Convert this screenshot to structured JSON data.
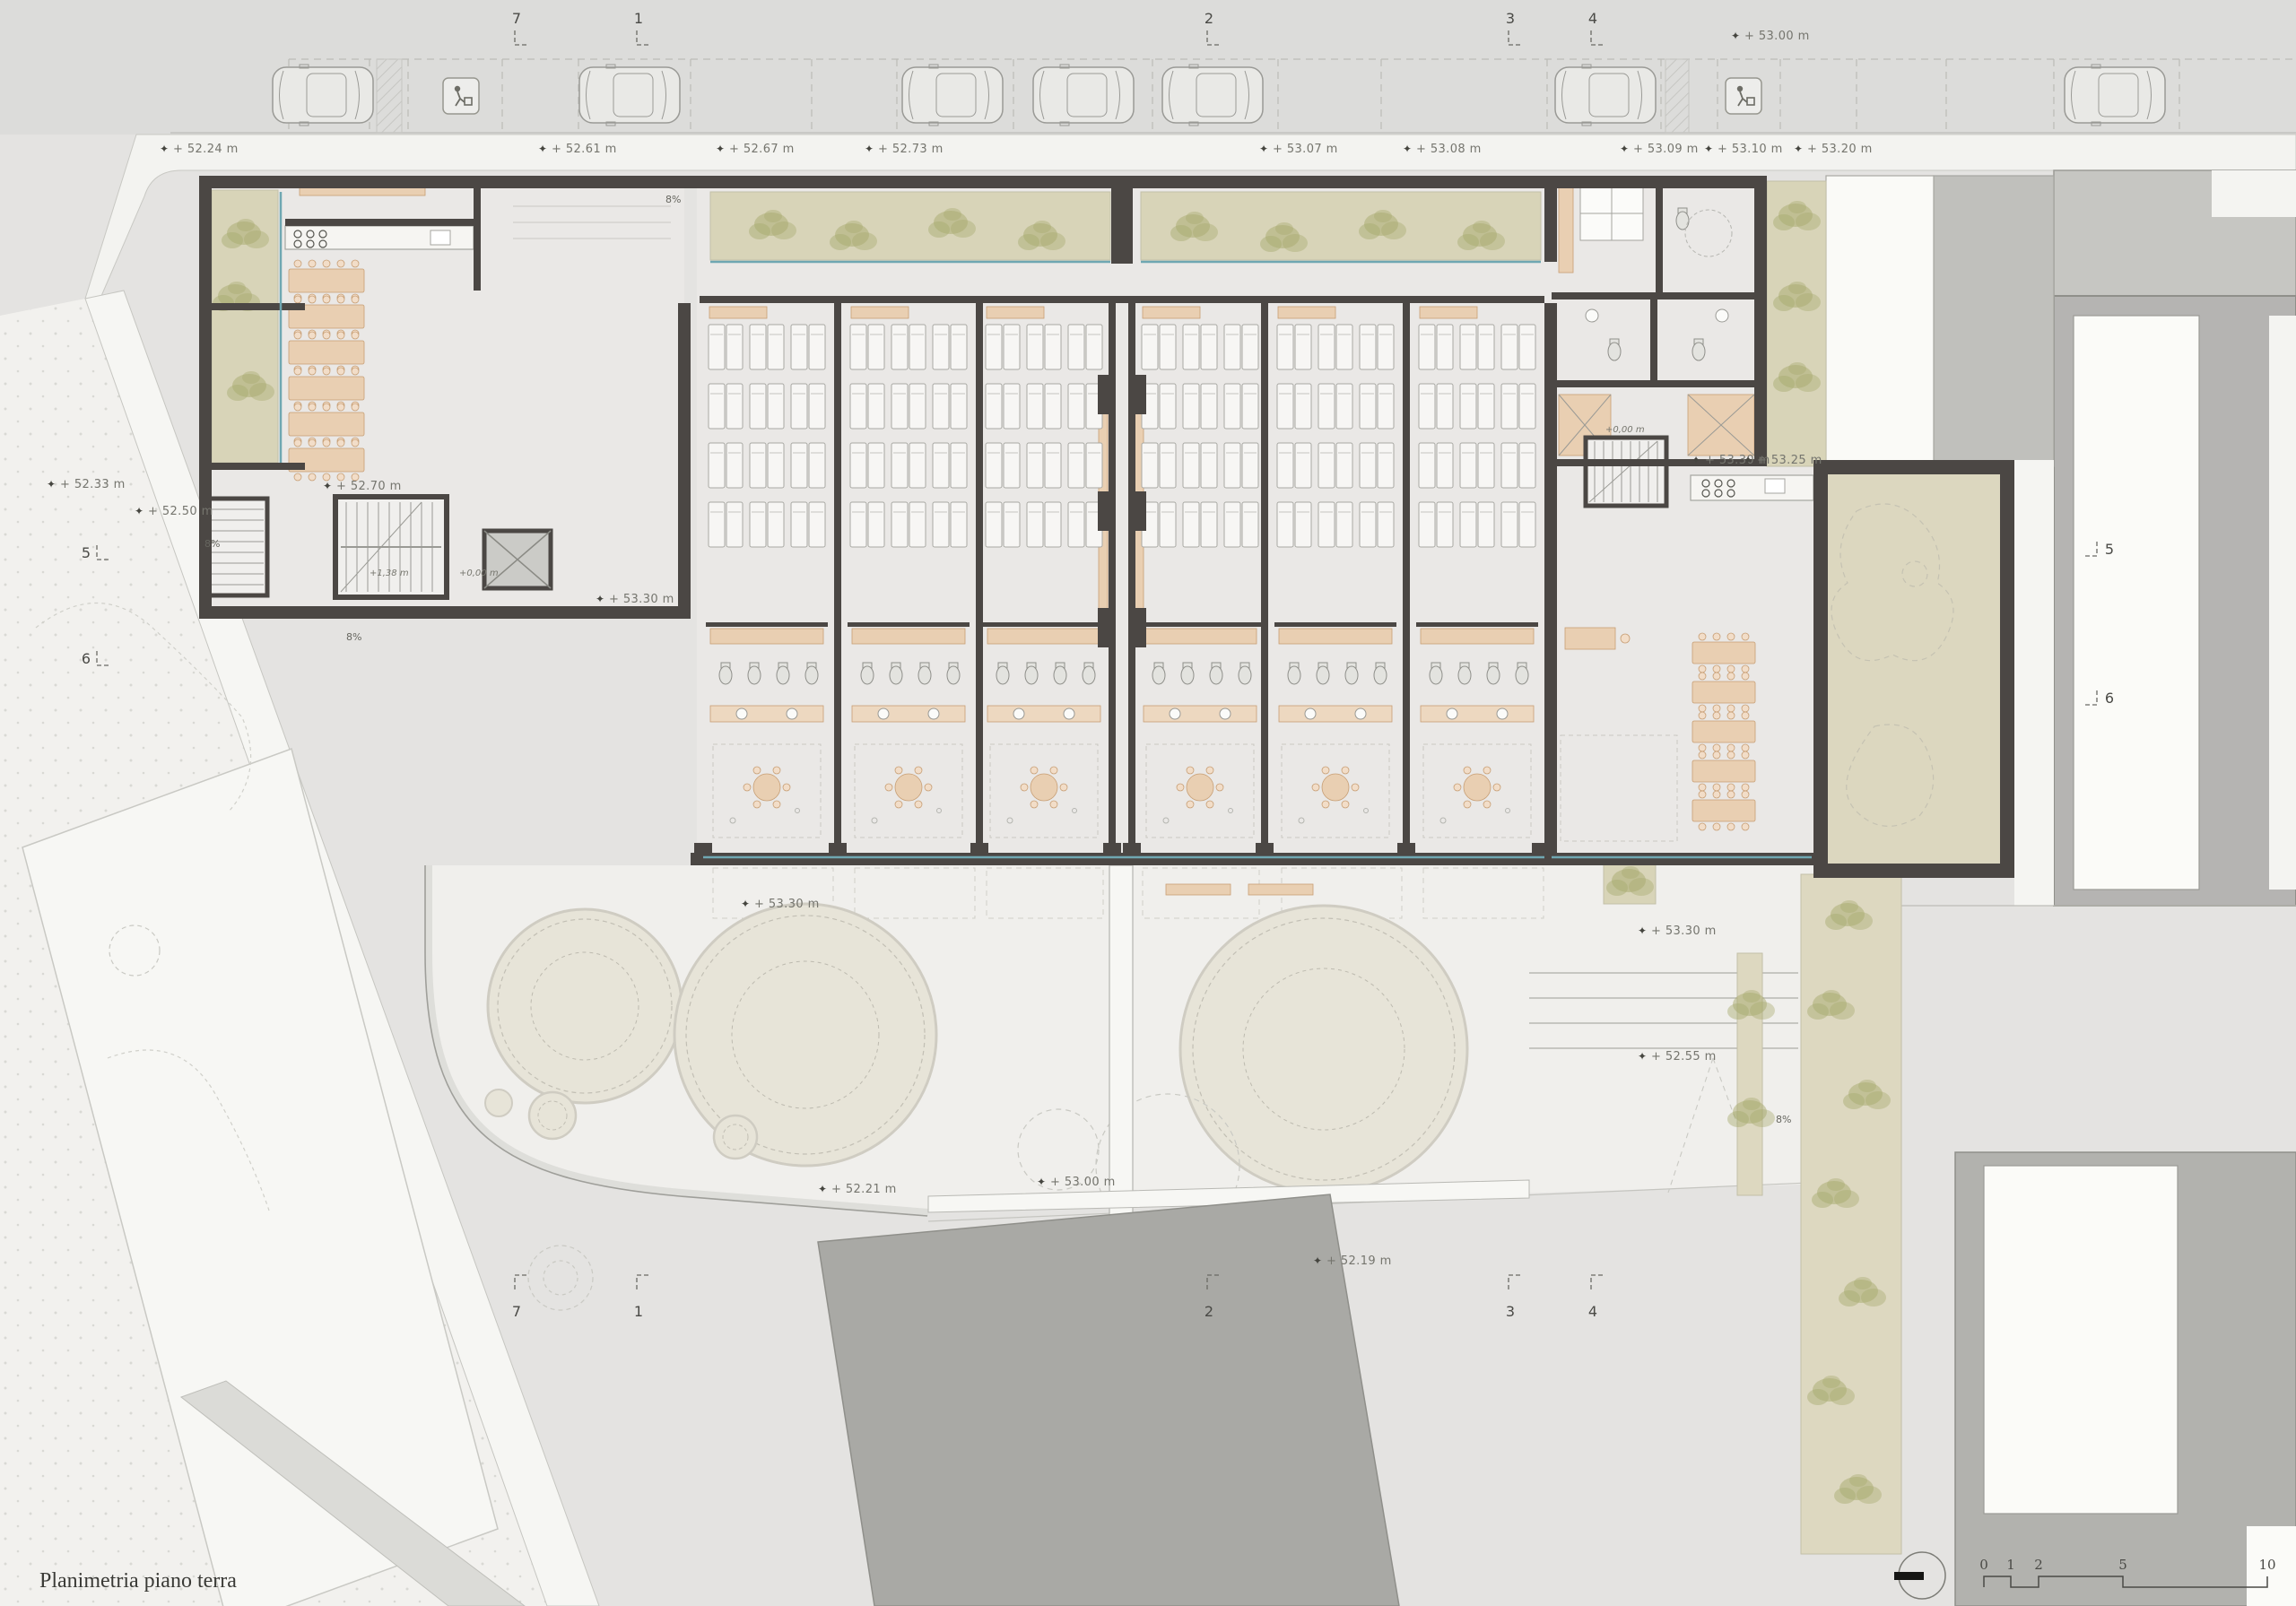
{
  "title": "Planimetria piano terra",
  "icons": {
    "level": "✦"
  },
  "grid": {
    "top": [
      "7",
      "1",
      "2",
      "3",
      "4"
    ],
    "bottom": [
      "7",
      "1",
      "2",
      "3",
      "4"
    ],
    "left": [
      "5",
      "6"
    ],
    "right": [
      "5",
      "6"
    ]
  },
  "elevations": [
    "+ 53.00 m",
    "+ 52.24 m",
    "+ 52.61 m",
    "+ 52.67 m",
    "+ 52.73 m",
    "+ 53.07 m",
    "+ 53.08 m",
    "+ 53.09 m",
    "+ 53.10 m",
    "+ 53.20 m",
    "+ 52.33 m",
    "+ 52.50 m",
    "+ 52.70 m",
    "+ 53.30 m",
    "+ 53.30 m",
    "+ 53.25 m",
    "+ 53.30 m",
    "+ 53.30 m",
    "+ 52.55 m",
    "+ 53.00 m",
    "+ 52.21 m",
    "+ 52.19 m"
  ],
  "stairs": [
    "+1,38 m",
    "+0,00 m",
    "+0,00 m"
  ],
  "ramps": [
    "8%",
    "8%",
    "8%",
    "8%"
  ],
  "scalebar": {
    "ticks": [
      "0",
      "1",
      "2",
      "5",
      "10"
    ]
  },
  "colors": {
    "site": "#e4e3e1",
    "road": "#dcdcda",
    "paper": "#f2f1ee",
    "terrace": "#f0efec",
    "floor": "#eae8e6",
    "wall": "#4b4744",
    "planting": "#d8d4b8",
    "foliage": "#a7aa6e",
    "garden": "#dcd7bf",
    "furniture": "#e9cfb2",
    "neighbor": "#b5b4b2",
    "glass": "#6fa7b2",
    "mound": "#e7e4d8"
  }
}
